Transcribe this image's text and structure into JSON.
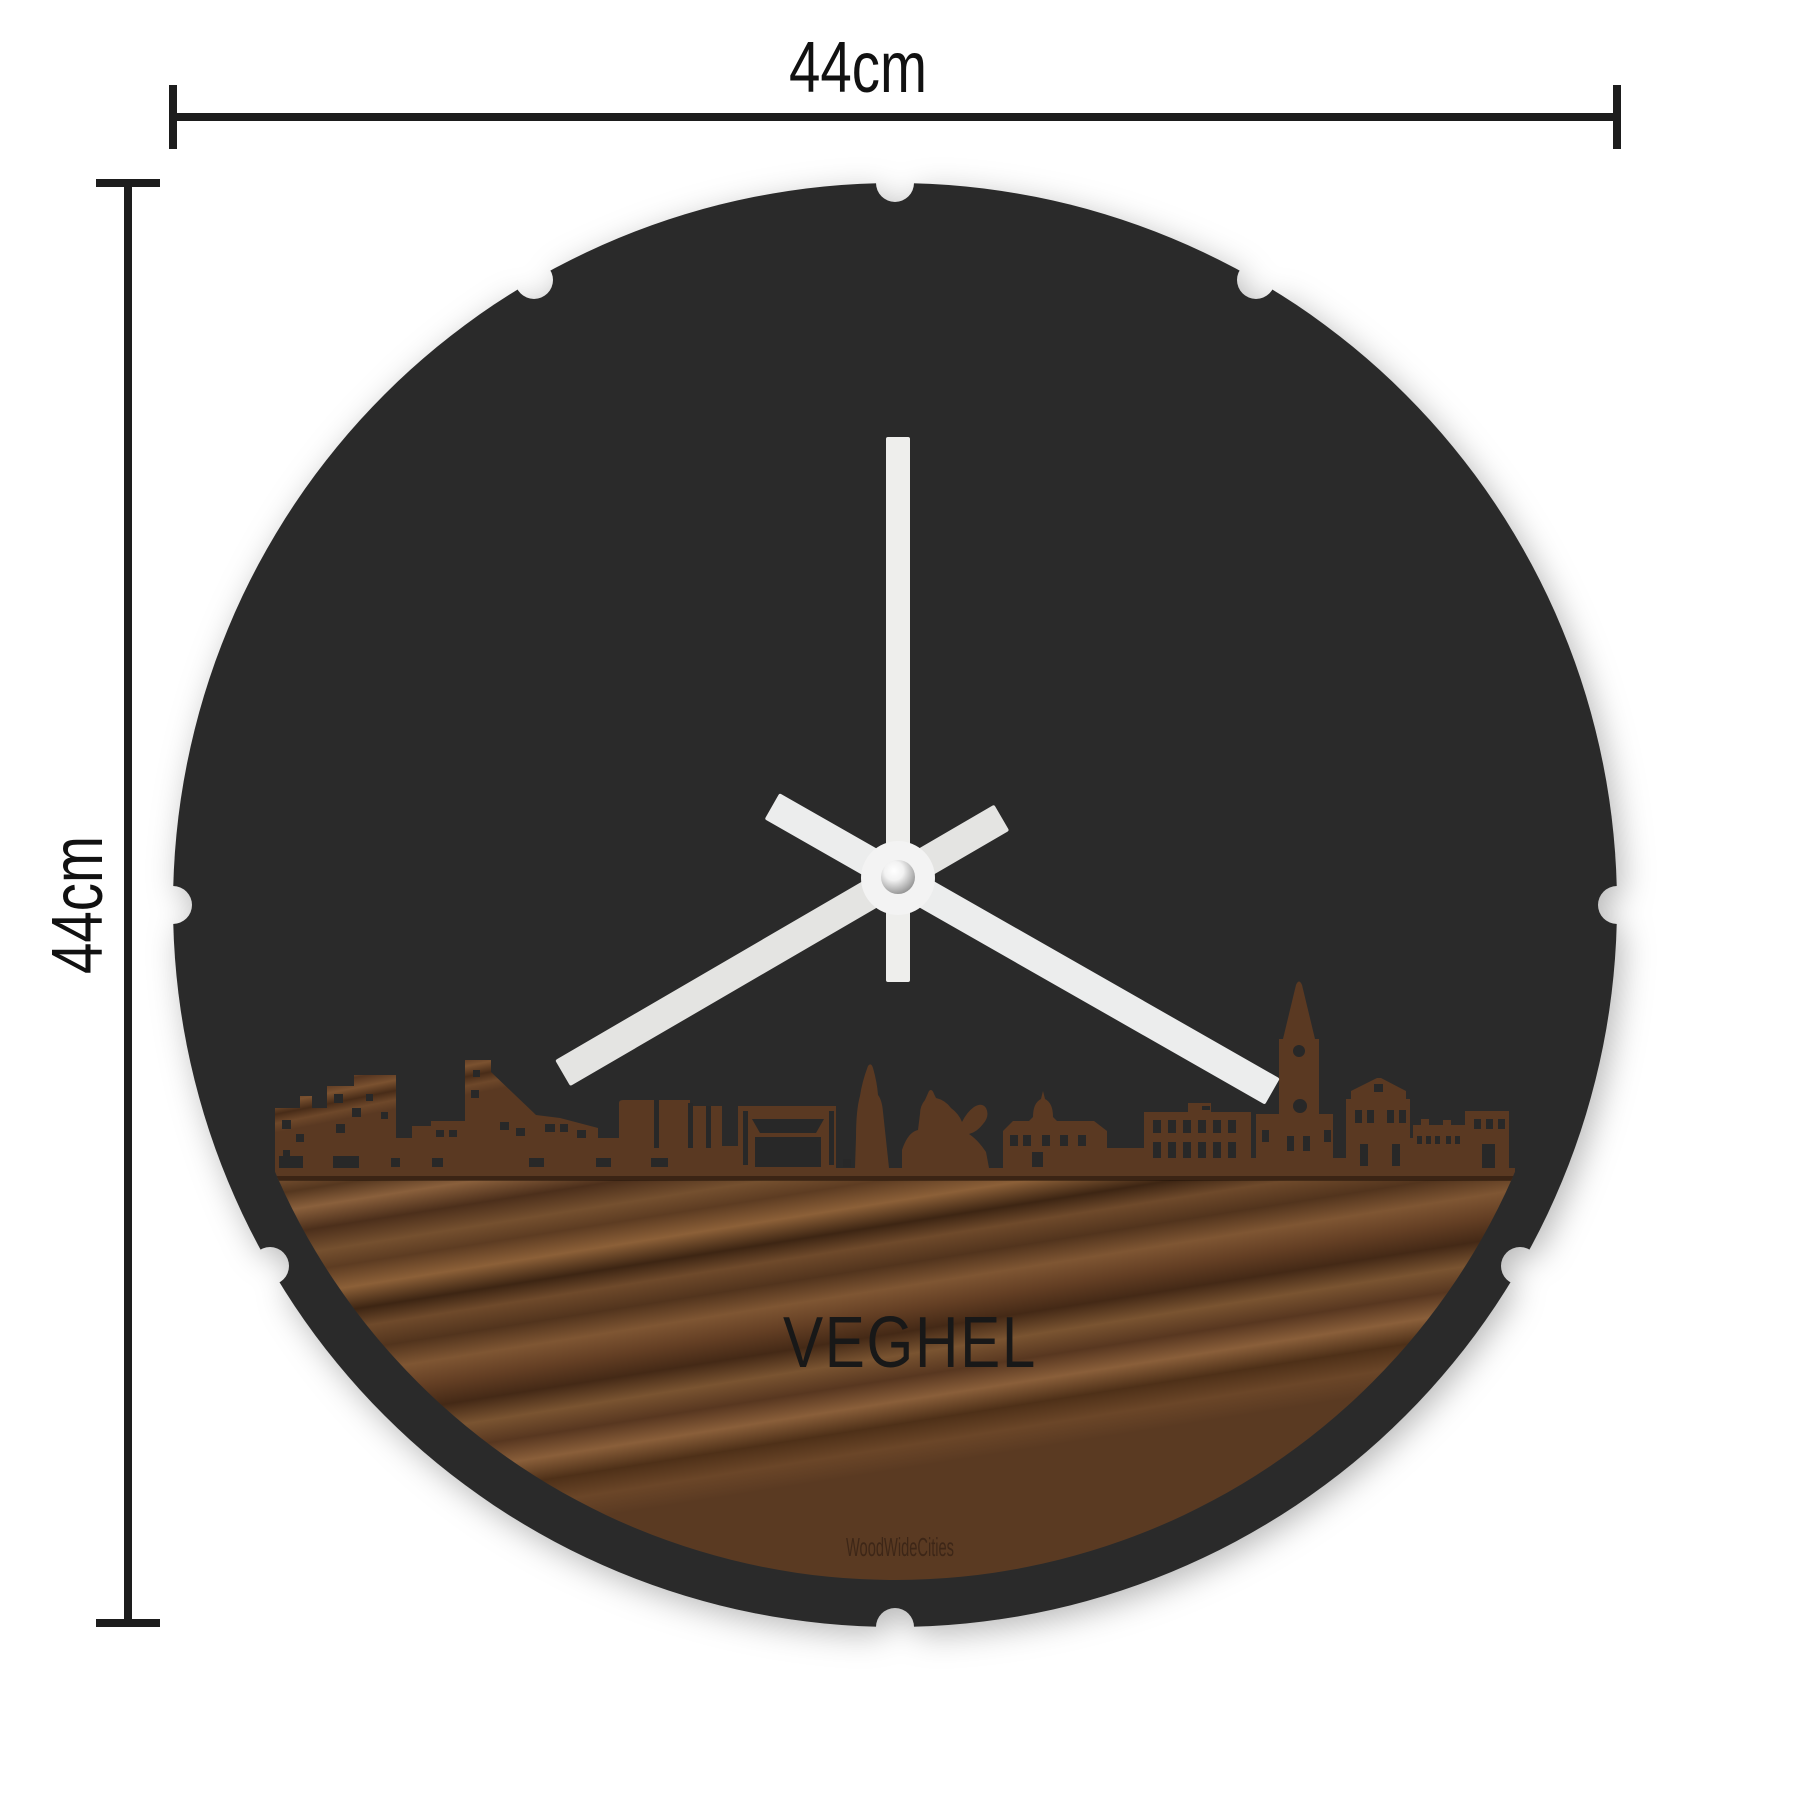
{
  "annotations": {
    "width_label": "44cm",
    "height_label": "44cm"
  },
  "clock": {
    "city_label": "VEGHEL",
    "watermark": "WoodWideCities",
    "hands_positions": {
      "hour_points_to": 8,
      "minute_points_to": 4,
      "second_points_to": 12
    }
  },
  "colors": {
    "background": "#ffffff",
    "clock_face": "#2b2b2b",
    "wood_mid": "#6b4629",
    "wood_dark": "#3f2715",
    "wood_light": "#8a603c",
    "hands": "#eaeae8",
    "center_cap": "#f3f3f3",
    "dimension_lines": "#1d1d1d",
    "city_label_color": "#181818"
  }
}
